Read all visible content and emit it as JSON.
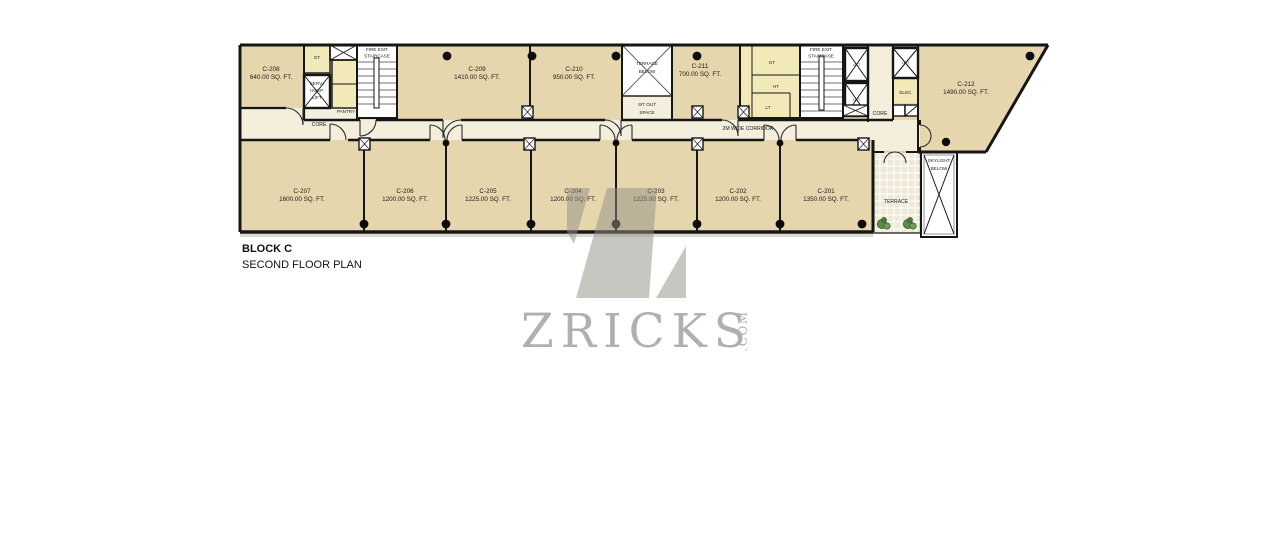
{
  "plan": {
    "block_title": "BLOCK C",
    "floor_title": "SECOND FLOOR PLAN",
    "corridor_label": "2M WIDE CORRIDOR"
  },
  "rooms_top": [
    {
      "id": "C-208",
      "area": "640.00 SQ. FT."
    },
    {
      "id": "C-209",
      "area": "1410.00 SQ. FT."
    },
    {
      "id": "C-210",
      "area": "950.00 SQ. FT."
    },
    {
      "id": "C-211",
      "area": "700.00 SQ. FT."
    },
    {
      "id": "C-212",
      "area": "1490.00 SQ. FT."
    }
  ],
  "rooms_bottom": [
    {
      "id": "C-207",
      "area": "1600.00 SQ. FT."
    },
    {
      "id": "C-206",
      "area": "1200.00 SQ. FT."
    },
    {
      "id": "C-205",
      "area": "1225.00 SQ. FT."
    },
    {
      "id": "C-204",
      "area": "1200.00 SQ. FT."
    },
    {
      "id": "C-203",
      "area": "1225.00 SQ. FT."
    },
    {
      "id": "C-202",
      "area": "1200.00 SQ. FT."
    },
    {
      "id": "C-201",
      "area": "1350.00 SQ. FT."
    }
  ],
  "core": {
    "core_left": "CORE",
    "core_right": "CORE",
    "pantry": "PANTRY",
    "fire_exit_line1": "FIRE EXIT",
    "fire_exit_line2": "STAIRCASE",
    "serv_lift_line1": "SERV./",
    "serv_lift_line2": "HOSP.",
    "serv_lift_line3": "LIFT",
    "gt_left": "GT",
    "gt_right": "GT",
    "ht": "HT",
    "lt": "LT",
    "lift": "LIFT",
    "elec": "ELEC."
  },
  "outdoor": {
    "terrace_below_line1": "TERRACE",
    "terrace_below_line2": "BELOW",
    "sit_out_line1": "SIT OUT",
    "sit_out_line2": "SPACE",
    "terrace": "TERRACE",
    "skylight_line1": "SKYLIGHT",
    "skylight_line2": "BELOW"
  },
  "watermark": {
    "brand": "ZRICKS",
    "tld": ".COM",
    "monogram_icon": "zricks-z-logo"
  },
  "icons": {
    "lift_shaft": "crossed-shaft-icon",
    "skylight_opening": "crossed-opening-icon",
    "plants": "shrub-icon"
  },
  "colors": {
    "room_fill": "#e6d6ae",
    "corridor_fill": "#f4eedd",
    "wet_area_fill": "#f2e9b8",
    "wall": "#161616",
    "watermark": "#b2b0af"
  }
}
